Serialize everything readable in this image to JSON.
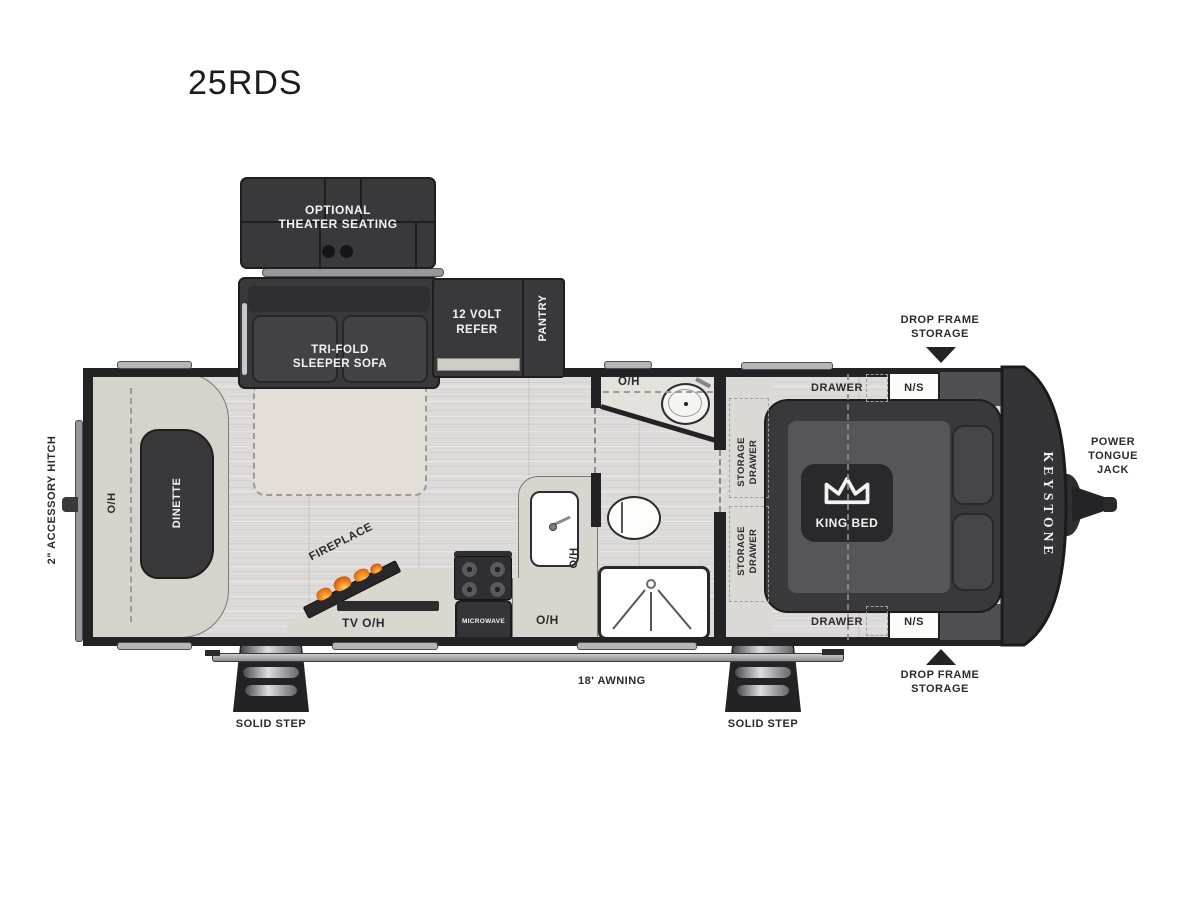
{
  "title": "25RDS",
  "colors": {
    "furniture_dark": "#39393b",
    "wall": "#232325",
    "floor": "#dcdbd9",
    "counter": "#d8d5cf",
    "flame_orange": "#ef7f1a",
    "label_dark": "#2b2b2d",
    "label_light": "#f2f2f2"
  },
  "labels": {
    "oh": "O/H",
    "accessory_hitch": "2\" ACCESSORY HITCH",
    "theater_line1": "OPTIONAL",
    "theater_line2": "THEATER SEATING",
    "sofa_line1": "TRI-FOLD",
    "sofa_line2": "SLEEPER SOFA",
    "refer_line1": "12 VOLT",
    "refer_line2": "REFER",
    "pantry": "PANTRY",
    "dinette": "DINETTE",
    "fireplace": "FIREPLACE",
    "tv_oh": "TV O/H",
    "microwave": "MICROWAVE",
    "storage_line1": "STORAGE",
    "storage_line2": "DRAWER",
    "drawer": "DRAWER",
    "ns": "N/S",
    "king_bed": "KING BED",
    "keystone": "KEYSTONE",
    "ptj_line1": "POWER",
    "ptj_line2": "TONGUE",
    "ptj_line3": "JACK",
    "drop_frame_line1": "DROP FRAME",
    "drop_frame_line2": "STORAGE",
    "awning": "18' AWNING",
    "solid_step": "SOLID STEP"
  }
}
